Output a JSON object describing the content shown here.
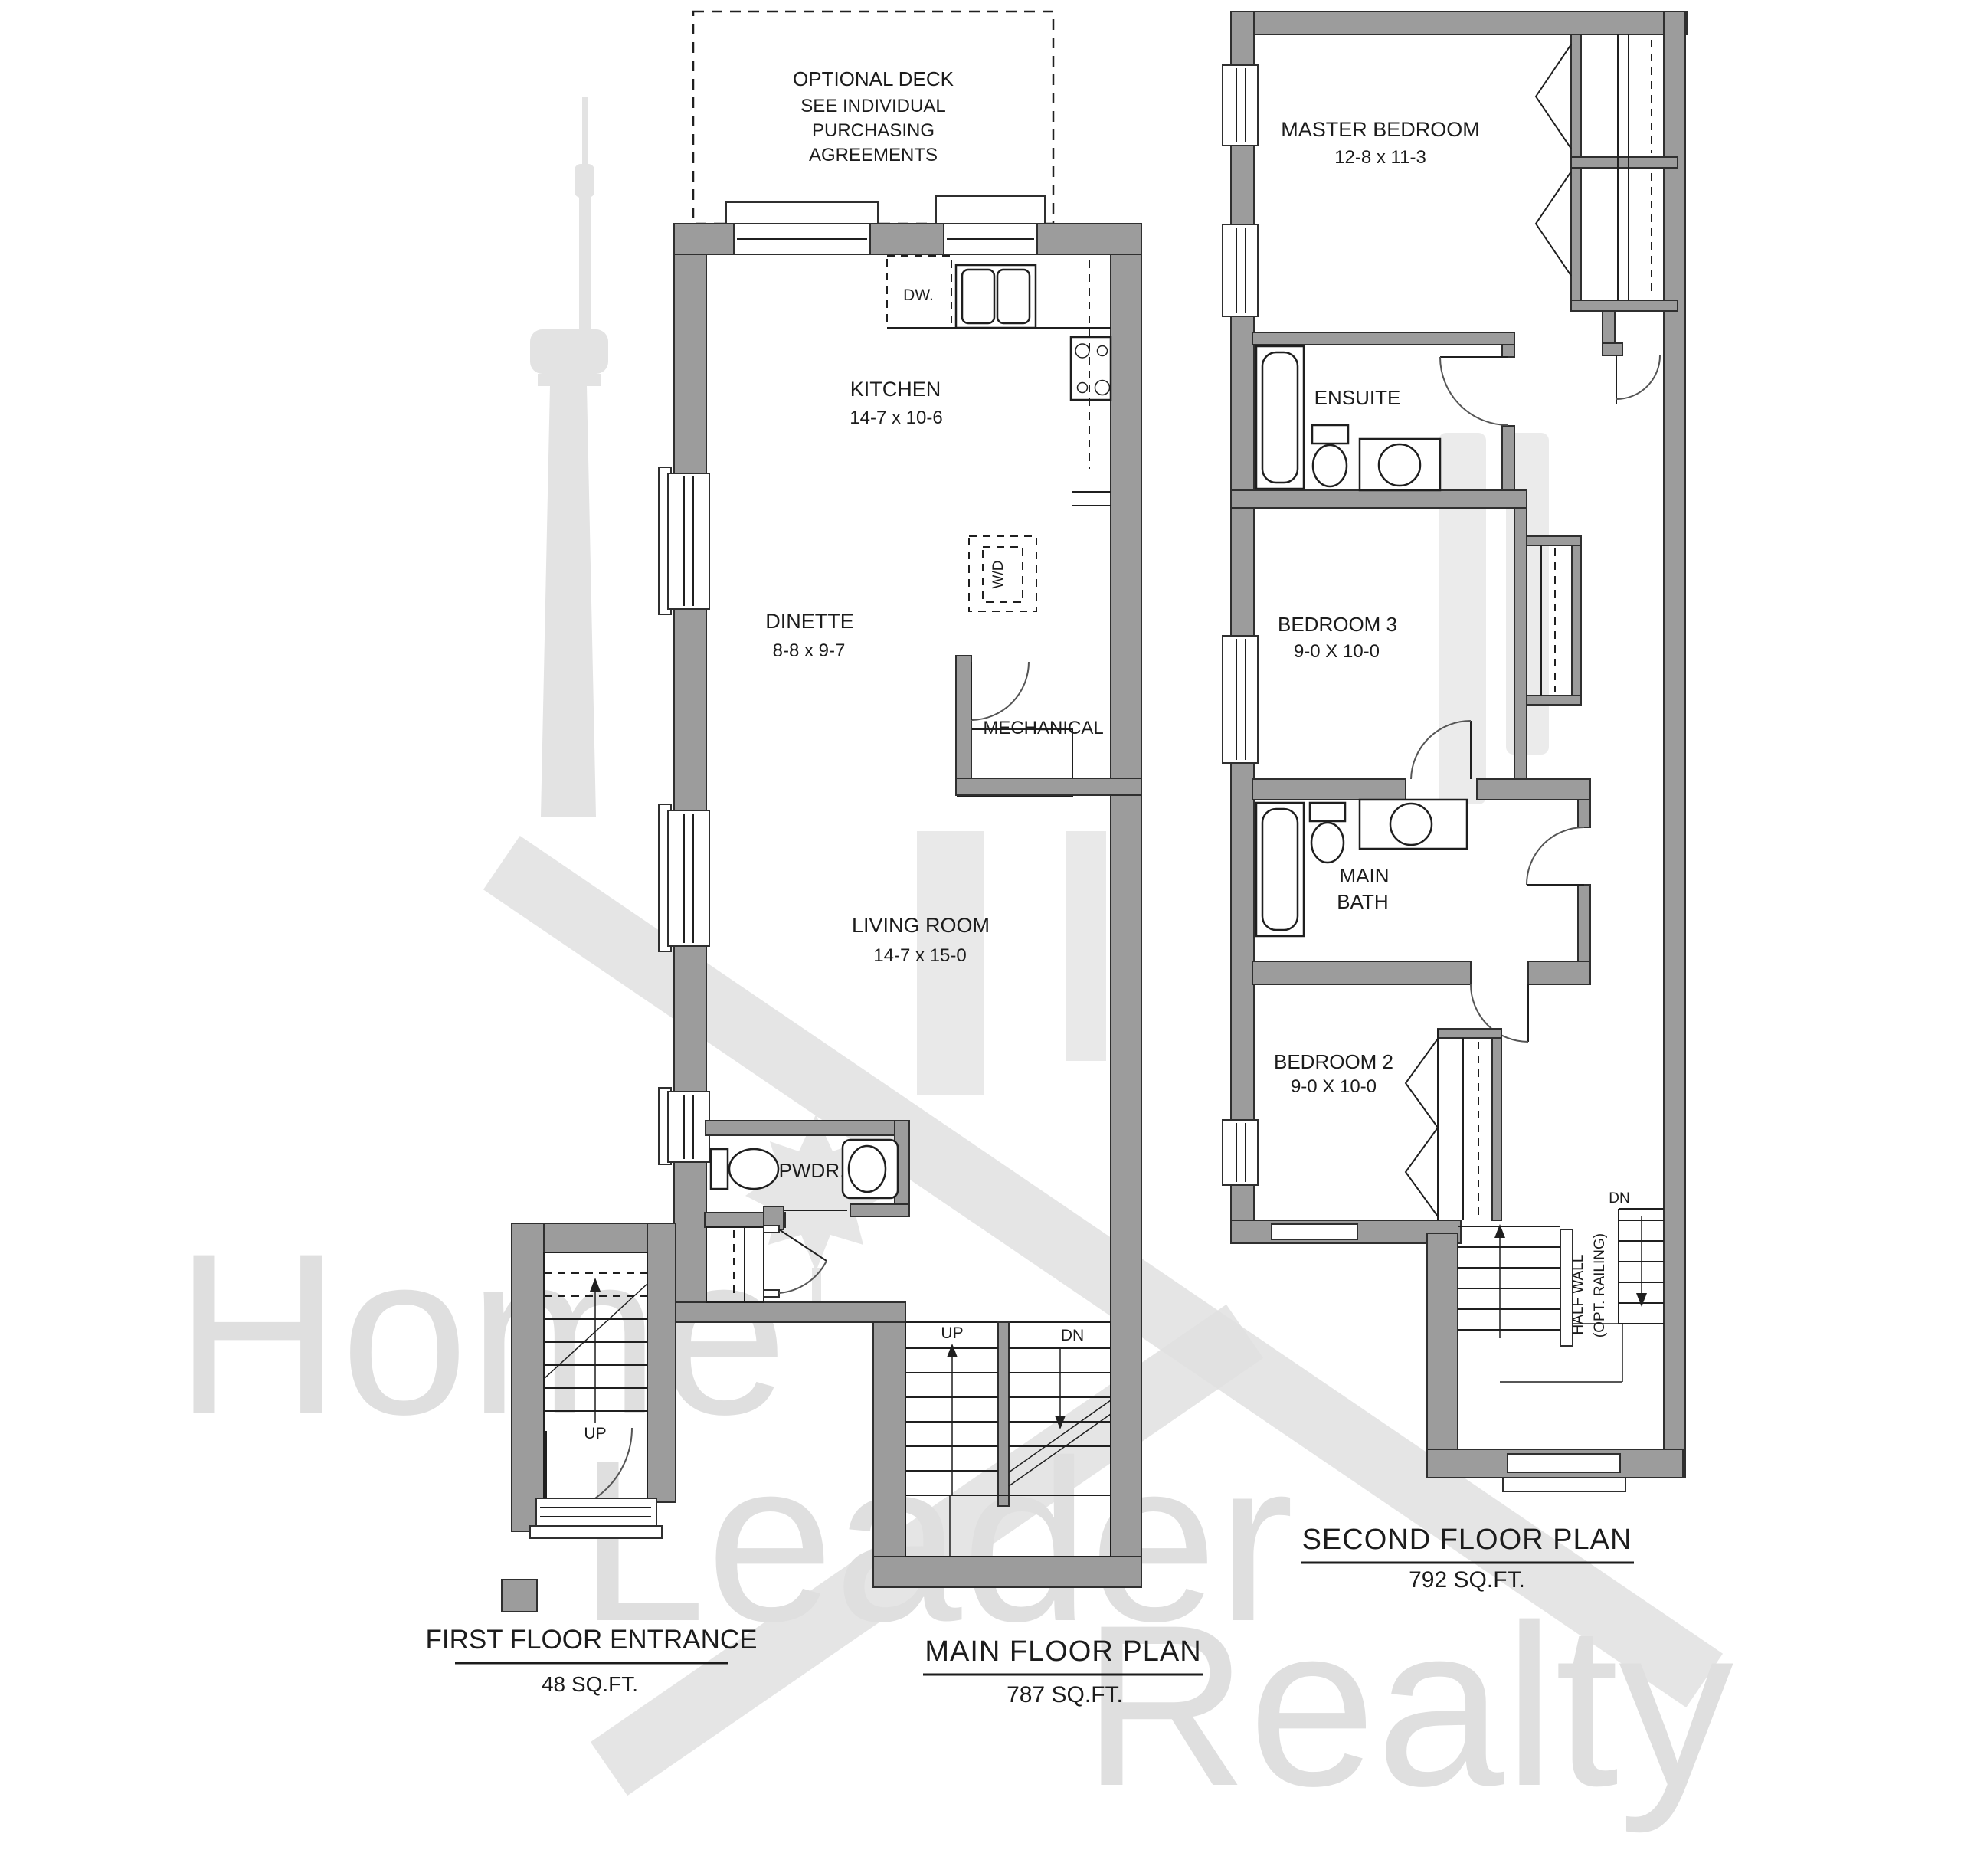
{
  "watermark": {
    "word1": "Home",
    "word2": "Leader",
    "word3": "Realty"
  },
  "deck": {
    "line1": "OPTIONAL DECK",
    "line2": "SEE INDIVIDUAL",
    "line3": "PURCHASING",
    "line4": "AGREEMENTS"
  },
  "main_floor": {
    "dishwasher": "DW.",
    "kitchen_name": "KITCHEN",
    "kitchen_size": "14-7 x 10-6",
    "washer_dryer": "W/D",
    "dinette_name": "DINETTE",
    "dinette_size": "8-8 x 9-7",
    "mechanical": "MECHANICAL",
    "living_name": "LIVING ROOM",
    "living_size": "14-7 x 15-0",
    "powder": "PWDR.",
    "stairs_up": "UP",
    "stairs_dn": "DN",
    "title": "MAIN FLOOR PLAN",
    "area": "787 SQ.FT."
  },
  "first_floor_entrance": {
    "stairs_up": "UP",
    "title": "FIRST FLOOR ENTRANCE",
    "area": "48 SQ.FT."
  },
  "second_floor": {
    "master_name": "MASTER BEDROOM",
    "master_size": "12-8 x 11-3",
    "ensuite": "ENSUITE",
    "bedroom3_name": "BEDROOM 3",
    "bedroom3_size": "9-0 X 10-0",
    "bath_line1": "MAIN",
    "bath_line2": "BATH",
    "bedroom2_name": "BEDROOM 2",
    "bedroom2_size": "9-0 X 10-0",
    "half_wall_line1": "HALF WALL",
    "half_wall_line2": "(OPT. RAILING)",
    "stairs_dn": "DN",
    "title": "SECOND FLOOR PLAN",
    "area": "792 SQ.FT."
  },
  "colors": {
    "wall": "#9c9c9c",
    "line": "#1f1f1f",
    "watermark": "#dfdfdf"
  }
}
